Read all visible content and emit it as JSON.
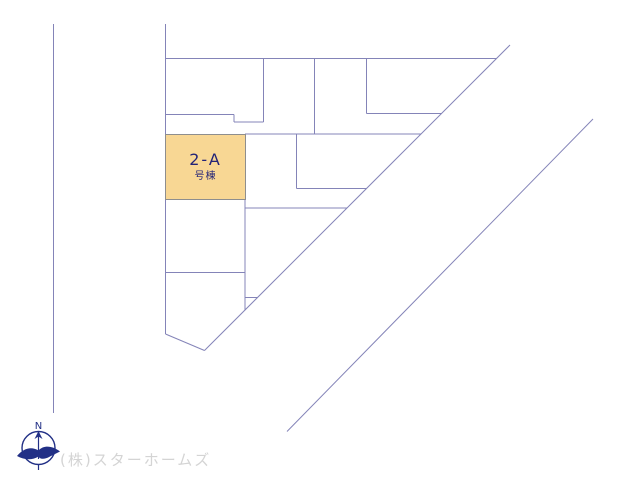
{
  "site_plan": {
    "highlighted_lot": {
      "label": "2-A",
      "sublabel": "号棟",
      "fill_color": "#F8D794",
      "border_color": "#8e8e8e",
      "text_color": "#232377"
    },
    "line_color": "#8484b8",
    "segments": [
      {
        "name": "left-boundary",
        "x1": 53.5,
        "y1": 24,
        "x2": 53.5,
        "y2": 413
      },
      {
        "name": "block-left",
        "x1": 165.5,
        "y1": 24,
        "x2": 165.5,
        "y2": 334
      },
      {
        "name": "block-top",
        "x1": 165.5,
        "y1": 58.5,
        "x2": 496.5,
        "y2": 58.5
      },
      {
        "name": "v-divider-1",
        "x1": 263.5,
        "y1": 58.5,
        "x2": 263.5,
        "y2": 122
      },
      {
        "name": "h-step-left",
        "x1": 165.5,
        "y1": 114.5,
        "x2": 234,
        "y2": 114.5
      },
      {
        "name": "v-step",
        "x1": 234,
        "y1": 114.5,
        "x2": 234,
        "y2": 122
      },
      {
        "name": "h-step-right",
        "x1": 234,
        "y1": 122,
        "x2": 263.5,
        "y2": 122
      },
      {
        "name": "v-divider-2",
        "x1": 314.5,
        "y1": 58.5,
        "x2": 314.5,
        "y2": 134
      },
      {
        "name": "h-lot-top-extension",
        "x1": 245,
        "y1": 134,
        "x2": 421,
        "y2": 134
      },
      {
        "name": "v-divider-3",
        "x1": 296.5,
        "y1": 134,
        "x2": 296.5,
        "y2": 188.5
      },
      {
        "name": "h-divider-mid",
        "x1": 296.5,
        "y1": 188.5,
        "x2": 366.5,
        "y2": 188.5
      },
      {
        "name": "v-divider-4",
        "x1": 366.5,
        "y1": 58.5,
        "x2": 366.5,
        "y2": 113.5
      },
      {
        "name": "h-divider-right",
        "x1": 366.5,
        "y1": 113.5,
        "x2": 441.5,
        "y2": 113.5
      },
      {
        "name": "v-lot-right",
        "x1": 245,
        "y1": 134,
        "x2": 245,
        "y2": 310.5
      },
      {
        "name": "h-divider-lower",
        "x1": 245,
        "y1": 208,
        "x2": 347,
        "y2": 208
      },
      {
        "name": "h-lower-lot",
        "x1": 165.5,
        "y1": 272.5,
        "x2": 245,
        "y2": 272.5
      },
      {
        "name": "h-small-triangle",
        "x1": 245,
        "y1": 297.5,
        "x2": 257.5,
        "y2": 297.5
      },
      {
        "name": "bottom-angled-edge",
        "x1": 165.5,
        "y1": 334,
        "x2": 204.5,
        "y2": 350.5
      },
      {
        "name": "road-diagonal-inner",
        "x1": 510,
        "y1": 45,
        "x2": 204.5,
        "y2": 350.5
      },
      {
        "name": "road-diagonal-outer",
        "x1": 593,
        "y1": 119,
        "x2": 287,
        "y2": 431.5
      }
    ]
  },
  "compass": {
    "north_label": "N",
    "color": "#223086"
  },
  "watermark": {
    "company_text": "(株)スターホームズ",
    "color": "#d4d4d4"
  }
}
